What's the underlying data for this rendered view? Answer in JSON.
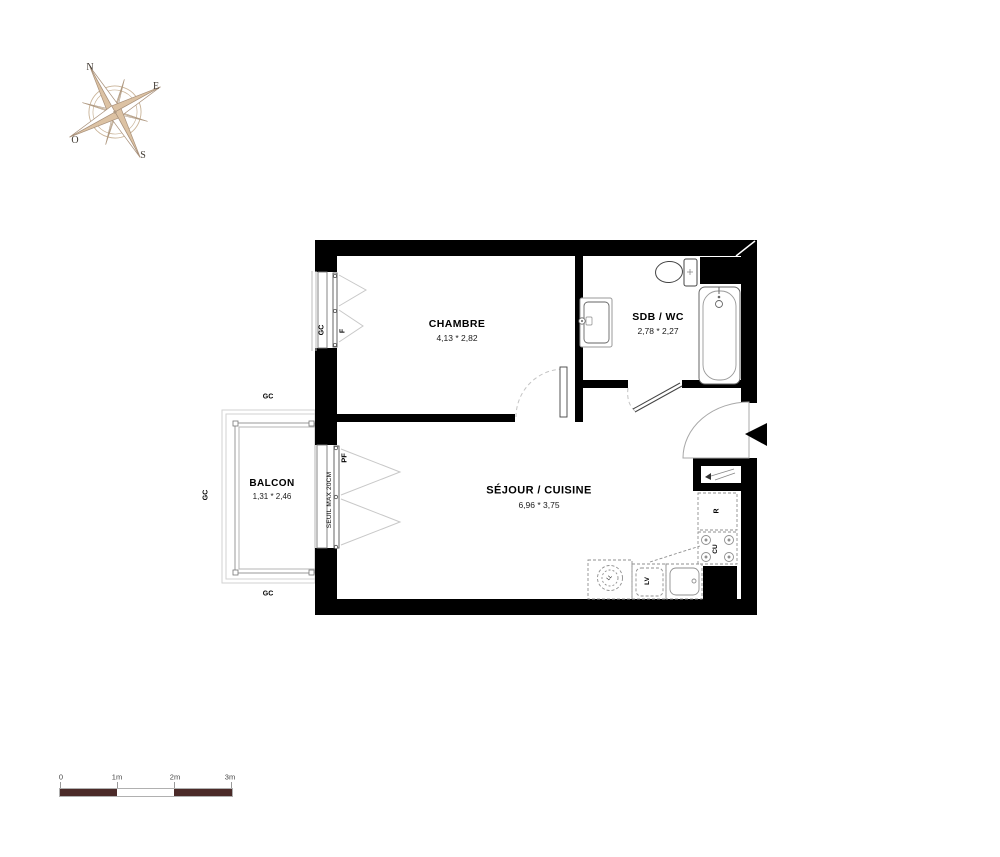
{
  "compass": {
    "n": "N",
    "e": "E",
    "s": "S",
    "o": "O"
  },
  "rooms": {
    "chambre": {
      "name": "CHAMBRE",
      "dims": "4,13 * 2,82"
    },
    "sdb": {
      "name": "SDB / WC",
      "dims": "2,78 * 2,27"
    },
    "sejour": {
      "name": "SÉJOUR / CUISINE",
      "dims": "6,96 * 3,75"
    },
    "balcon": {
      "name": "BALCON",
      "dims": "1,31 * 2,46"
    }
  },
  "labels": {
    "gc": "GC",
    "f": "F",
    "pf": "PF",
    "seuil": "SEUIL MAX 20CM",
    "ll": "LL",
    "lv": "LV",
    "cu": "CU",
    "r": "R"
  },
  "scale_bar": {
    "t0": "0",
    "t1": "1m",
    "t2": "2m",
    "t3": "3m"
  },
  "colors": {
    "wall": "#000000",
    "thin_line": "#9a9a9a",
    "dashed_fixture": "#8f8f8f",
    "scale_dark": "#4b2a28",
    "compass_tan": "#dcc2a3",
    "compass_outline": "#b09a82"
  }
}
